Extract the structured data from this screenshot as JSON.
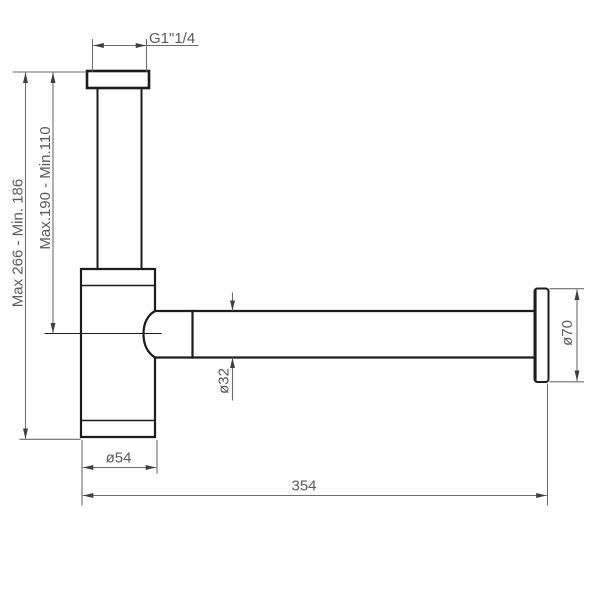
{
  "colors": {
    "background": "#ffffff",
    "outline": "#1c1c1c",
    "dimension_line": "#6e6e6e",
    "dimension_arrow": "#3f3f3f",
    "dimension_text": "#5a5a5a"
  },
  "labels": {
    "inlet_thread": "G1\"1/4",
    "total_height_range": "Max 266 - Min. 186",
    "inlet_height_range": "Max.190 - Min.110",
    "pipe_diameter": "ø32",
    "body_diameter": "ø54",
    "total_length": "354",
    "flange_diameter": "ø70"
  }
}
